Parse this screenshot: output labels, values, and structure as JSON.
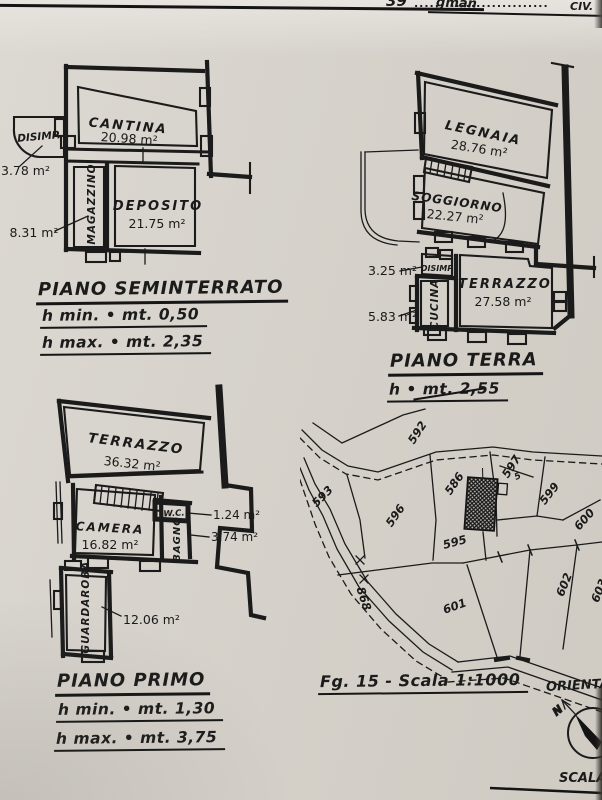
{
  "header": {
    "page_fragment": "39",
    "dots": "..........................",
    "script_fragment": "gman",
    "right_fragment": "CIV."
  },
  "plans": {
    "seminterrato": {
      "title": "PIANO SEMINTERRATO",
      "h_min": "h min. • mt. 0,50",
      "h_max": "h max. • mt. 2,35",
      "rooms": {
        "disimp": {
          "name": "DISIMP.",
          "area": "3.78 m²"
        },
        "cantina": {
          "name": "CANTINA",
          "area": "20.98 m²"
        },
        "magazzino": {
          "name": "MAGAZZINO",
          "area": "8.31 m²"
        },
        "deposito": {
          "name": "DEPOSITO",
          "area": "21.75 m²"
        }
      }
    },
    "terra": {
      "title": "PIANO TERRA",
      "h": "h • mt. 2,55",
      "rooms": {
        "legnaia": {
          "name": "LEGNAIA",
          "area": "28.76 m²"
        },
        "soggiorno": {
          "name": "SOGGIORNO",
          "area": "22.27 m²"
        },
        "disimp": {
          "name": "DISIMP",
          "area": "3.25 m²"
        },
        "cucina": {
          "name": "CUCINA",
          "area": "5.83 m²"
        },
        "terrazzo": {
          "name": "TERRAZZO",
          "area": "27.58 m²"
        }
      }
    },
    "primo": {
      "title": "PIANO PRIMO",
      "h_min": "h min. • mt. 1,30",
      "h_max": "h max. • mt. 3,75",
      "rooms": {
        "terrazzo": {
          "name": "TERRAZZO",
          "area": "36.32 m²"
        },
        "camera": {
          "name": "CAMERA",
          "area": "16.82 m²"
        },
        "wc": {
          "name": "W.C.",
          "area": "1.24 m²"
        },
        "bagno": {
          "name": "BAGNO",
          "area": "3.74 m²"
        },
        "guardaroba": {
          "name": "GUARDAROBA",
          "area": "12.06 m²"
        }
      }
    }
  },
  "map": {
    "caption": "Fg. 15 - Scala 1:1000",
    "orientation_label": "ORIENTAM",
    "scale_label": "SCALA L",
    "north": "N",
    "parcels": {
      "p592": "592",
      "p593": "593",
      "p596": "596",
      "p586": "586",
      "p595": "595",
      "p597": "597",
      "p5": "5",
      "p599": "599",
      "p600": "600",
      "p601": "601",
      "p602": "602",
      "p603": "603",
      "p868": "868"
    }
  },
  "colors": {
    "paper": "#d6d2cb",
    "ink": "#1b1b1b"
  }
}
